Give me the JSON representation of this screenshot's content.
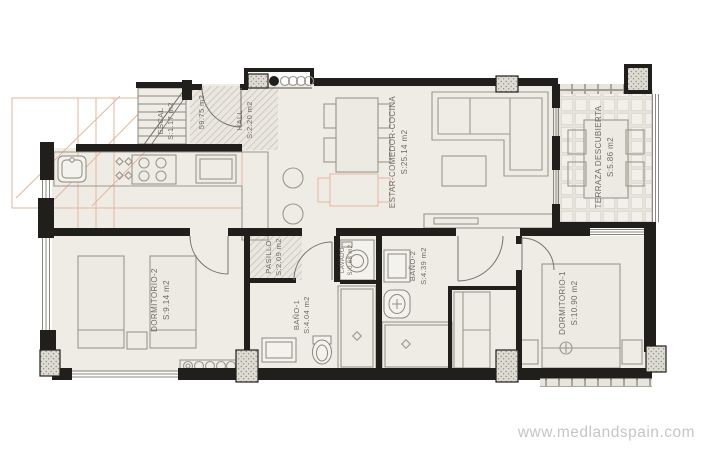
{
  "branding": {
    "watermark": "www.medlandspain.com"
  },
  "plan": {
    "total_area": "59.75 m2",
    "rooms": {
      "escalera": {
        "name": "ESCAL",
        "area": "S:1.17 m2"
      },
      "hall": {
        "name": "HALL",
        "area": "S:2.20 m2"
      },
      "estar_comedor_cocina": {
        "name": "ESTAR-COMEDOR-COCINA",
        "area": "S:25.14 m2"
      },
      "terraza_descubierta": {
        "name": "TERRAZA DESCUBIERTA",
        "area": "S:5.86 m2"
      },
      "dormitorio_2": {
        "name": "DORMITORIO-2",
        "area": "S:9.14 m2"
      },
      "pasillo": {
        "name": "PASILLO",
        "area": "S:2.09 m2"
      },
      "lavado": {
        "name": "LAVADO",
        "area": "S:0.68 m2"
      },
      "bano_1": {
        "name": "BAÑO-1",
        "area": "S:4.04 m2"
      },
      "bano_2": {
        "name": "BAÑO-2",
        "area": "S:4.39 m2"
      },
      "dormitorio_1": {
        "name": "DORMITORIO-1",
        "area": "S:10.90 m2"
      }
    },
    "colors": {
      "wall": "#211f1c",
      "floor": "#efece6",
      "accent_salmon": "#e3b79c",
      "hatch": "#bdb9af",
      "label": "#6e6b63",
      "watermark": "#c8c6c2"
    }
  }
}
